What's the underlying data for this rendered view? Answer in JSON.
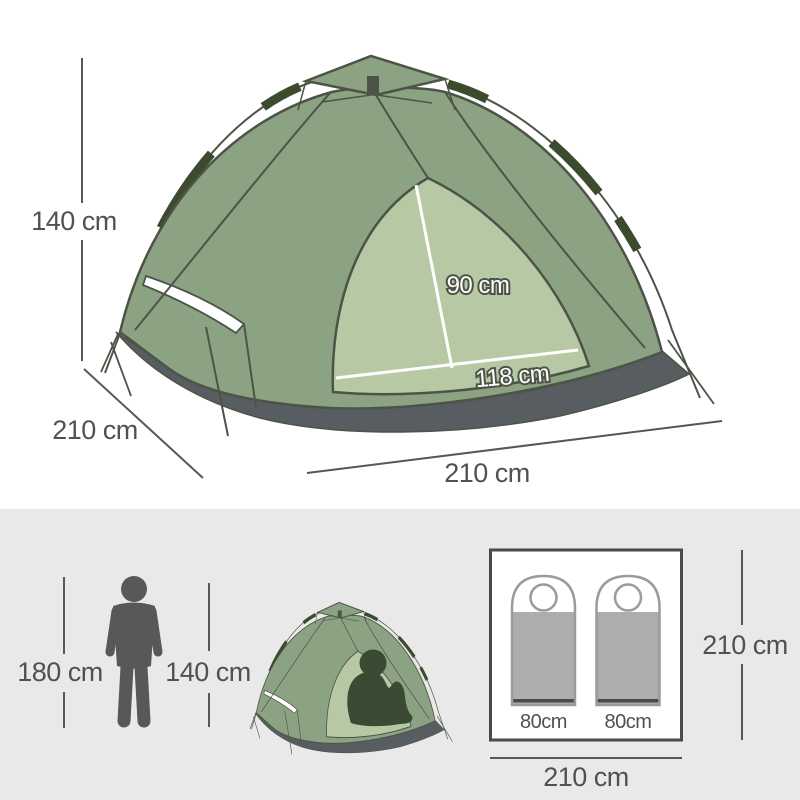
{
  "upper": {
    "height": "140 cm",
    "depth": "210 cm",
    "width": "210 cm",
    "door_height": "90 cm",
    "door_width": "118 cm"
  },
  "lower": {
    "person_height": "180 cm",
    "tent_height": "140 cm",
    "plan": {
      "bag_left": "80cm",
      "bag_right": "80cm",
      "depth": "210 cm",
      "width": "210 cm"
    }
  },
  "colors": {
    "tent_body": "#8CA383",
    "tent_door": "#B7C9A4",
    "pole_sleeve": "#3C4A2D",
    "tent_outline": "#4D5447",
    "groundsheet": "#575D61",
    "lower_background": "#E9E9E9",
    "dimension_text": "#4F5152",
    "person_silhouette": "#57585A",
    "sitting_person": "#3A4A33",
    "sleeping_bag_fill": "#ADADAD",
    "sleeping_bag_outline": "#9B9B9B",
    "sleeping_bag_strip": "#4A4A4A",
    "floor_plan_border": "#4A4A4A"
  }
}
